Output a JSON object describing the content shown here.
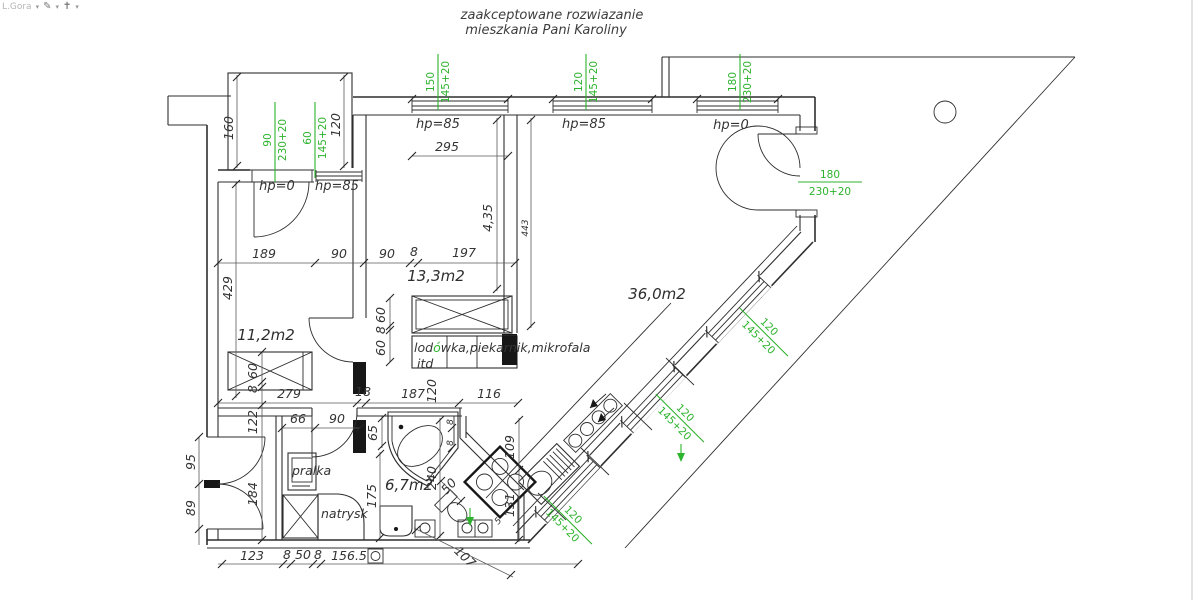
{
  "toolbar": {
    "layer_label": "L.Gora",
    "pen_icon": "pen-icon",
    "target_icon": "target-icon"
  },
  "title": {
    "line1": "zaakceptowane  rozwiazanie",
    "line2": "mieszkania  Pani  Karoliny"
  },
  "colors": {
    "green": "#2db32d",
    "line": "#2e2e2e",
    "background": "#ffffff"
  },
  "rooms": {
    "bedroom_left": "11,2m2",
    "bedroom_mid": "13,3m2",
    "living": "36,0m2",
    "bath": "6,7m2"
  },
  "fixtures": {
    "washer": "pralka",
    "shower": "natrysk",
    "appliances_pre": "lod",
    "appliances_o": "ó",
    "appliances_post": "wka,piekarnik,mikrofala",
    "appliances_etc": "itd"
  },
  "sills": {
    "balcony_door": "hp=0",
    "balcony_window": "hp=85",
    "win1": "hp=85",
    "win2": "hp=85",
    "win3": "hp=0"
  },
  "windows": {
    "top1_w": "150",
    "top1_h": "145+20",
    "top2_w": "120",
    "top2_h": "145+20",
    "top3_w": "180",
    "top3_h": "230+20",
    "bal1_w": "90",
    "bal1_h": "230+20",
    "bal2_w": "60",
    "bal2_h": "145+20",
    "door_w": "180",
    "door_h": "230+20",
    "diag1_w": "120",
    "diag1_h": "145+20",
    "diag2_w": "120",
    "diag2_h": "145+20",
    "diag3_w": "120",
    "diag3_h": "145+20"
  },
  "dims": {
    "balcony_depth": "160",
    "balcony_width": "120",
    "win1_width": "295",
    "room_left_height": "429",
    "chain_rooms": [
      "189",
      "90",
      "90",
      "8",
      "197"
    ],
    "room13_height": "4,35",
    "room13_height2": "443",
    "kitchen_chain": [
      "60",
      "8",
      "60"
    ],
    "chain_hall": [
      "279",
      "18",
      "187",
      "120",
      "116"
    ],
    "chain_left": [
      "60",
      "8",
      "122",
      "184"
    ],
    "chain_entry": [
      "95",
      "89"
    ],
    "chain_bath": [
      "66",
      "90"
    ],
    "bath_w": "65",
    "shower_h": "175",
    "bath_h": "240",
    "counter_a": "109",
    "counter_b": "131",
    "toilet_w": "50",
    "small5": "5",
    "tub_off1": "8",
    "tub_off2": "8",
    "chain_bottom": [
      "123",
      "8",
      "50",
      "8",
      "156.5"
    ],
    "diag_bottom": "107"
  }
}
